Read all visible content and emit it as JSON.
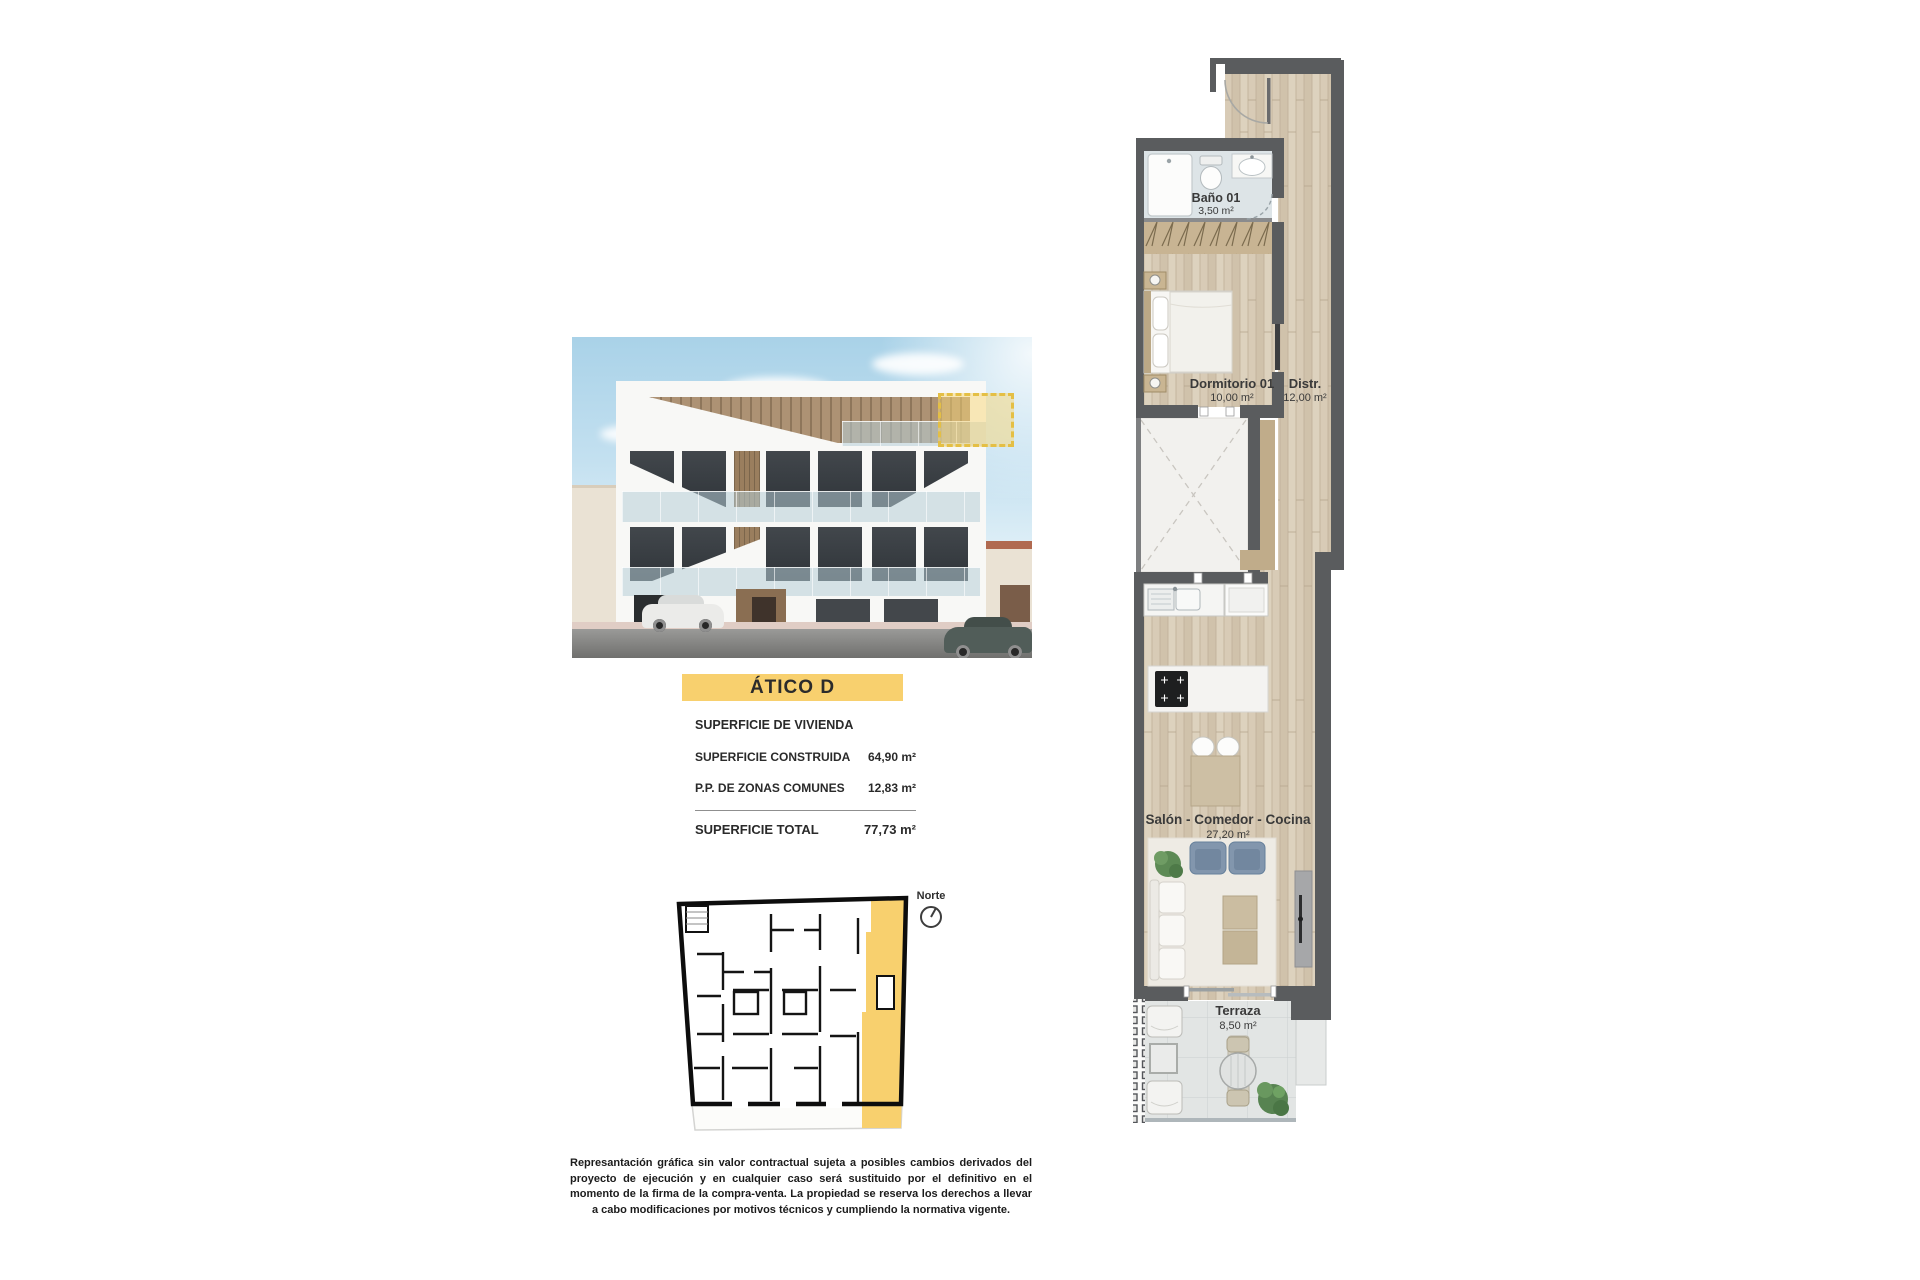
{
  "title_banner": {
    "label": "ÁTICO D"
  },
  "surface_panel": {
    "header": "SUPERFICIE DE VIVIENDA",
    "rows": [
      {
        "label": "SUPERFICIE CONSTRUIDA",
        "value": "64,90 m²"
      },
      {
        "label": "P.P. DE ZONAS COMUNES",
        "value": "12,83 m²"
      }
    ],
    "total": {
      "label": "SUPERFICIE TOTAL",
      "value": "77,73 m²"
    }
  },
  "floor_plan": {
    "rooms": [
      {
        "name": "Baño 01",
        "area": "3,50 m²"
      },
      {
        "name": "Dormitorio 01",
        "area": "10,00 m²"
      },
      {
        "name": "Distr.",
        "area": "12,00 m²"
      },
      {
        "name": "Salón - Comedor - Cocina",
        "area": "27,20 m²"
      },
      {
        "name": "Terraza",
        "area": "8,50 m²"
      }
    ]
  },
  "overview_plan": {
    "north_label": "Norte"
  },
  "disclaimer": {
    "text": "Represantación gráfica sin valor contractual sujeta a posibles cambios derivados del proyecto de ejecución y en cualquier caso será sustituido por el definitivo en el momento de la firma de la compra-venta. La propiedad se reserva los derechos a llevar a cabo modificaciones por motivos técnicos y cumpliendo la normativa vigente."
  },
  "colors": {
    "accent_yellow": "#f8d06e",
    "highlight_dash": "#e4bf45",
    "wall_gray": "#5a5c5e",
    "wood_floor": "#d8cbb6",
    "bath_floor": "#dde4e7",
    "terrace_floor": "#e2e5e4"
  }
}
